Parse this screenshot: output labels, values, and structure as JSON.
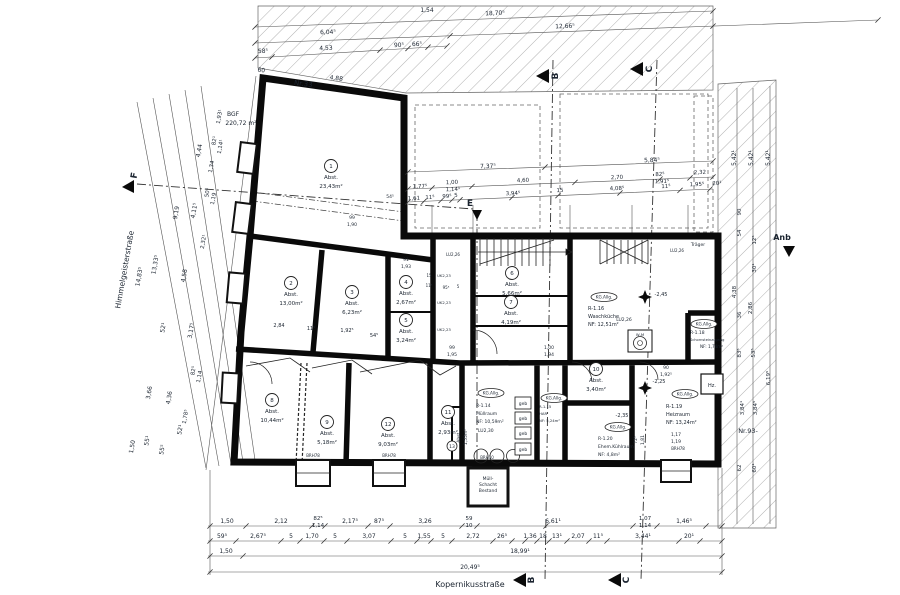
{
  "streets": {
    "left": "Himmelgeisterstraße",
    "bottom": "Kopernikusstraße"
  },
  "markers": {
    "b": "B",
    "c": "C",
    "e": "E",
    "f": "F"
  },
  "labels": {
    "kg": "KG.Allg.",
    "hz": "Hz.",
    "wm": "W-M",
    "traeger": "Träger",
    "geb": "geb",
    "brh78": "BRH78",
    "brh10": "BRH10",
    "lu226": "LU2,26",
    "lu230": "LU2,30",
    "uk223": "UK2,23",
    "lvl245": "-2,45",
    "lvl225": "-2,25",
    "lvl235": "-2,35",
    "muell1": "Müll-",
    "muell2": "Schacht",
    "muell3": "Bestand",
    "bgf1": "BGF",
    "bgf2": "220,72 m²",
    "nr33": "Nr.33",
    "nr93": "Nr.93-",
    "anb": "Anb"
  },
  "rooms": {
    "r1": {
      "num": "1",
      "label": "Abst.",
      "area": "23,43m²"
    },
    "r2": {
      "num": "2",
      "label": "Abst.",
      "area": "13,00m²"
    },
    "r3": {
      "num": "3",
      "label": "Abst.",
      "area": "6,23m²"
    },
    "r4": {
      "num": "4",
      "label": "Abst.",
      "area": "2,67m²"
    },
    "r5": {
      "num": "5",
      "label": "Abst.",
      "area": "3,24m²"
    },
    "r6": {
      "num": "6",
      "label": "Abst.",
      "area": "5,66m²"
    },
    "r7": {
      "num": "7",
      "label": "Abst.",
      "area": "4,19m²"
    },
    "r8": {
      "num": "8",
      "label": "Abst.",
      "area": "10,44m²"
    },
    "r9": {
      "num": "9",
      "label": "Abst.",
      "area": "5,18m²"
    },
    "r10": {
      "num": "10",
      "label": "Abst.",
      "area": "3,40m²"
    },
    "r11": {
      "num": "11",
      "label": "Abst.",
      "area": "2,93m²"
    },
    "r12": {
      "num": "12",
      "label": "Abst.",
      "area": "9,03m²"
    },
    "r13": {
      "num": "13",
      "label": "Abst.",
      "area": "1,55m²"
    }
  },
  "units": {
    "r114": {
      "code": "R-1.14",
      "name": "Müllraum",
      "nf": "NF: 10,59m²"
    },
    "r115": {
      "code": "R-1.15",
      "name": "HAR",
      "nf": "NF: 5,24m²"
    },
    "r116": {
      "code": "R-1.16",
      "name": "Waschküche",
      "nf": "NF: 12,51m²"
    },
    "r118": {
      "code": "R-1.18",
      "name": "Schornsteinzugang",
      "nf": "NF: 1,74m²"
    },
    "r119": {
      "code": "R-1.19",
      "name": "Heizraum",
      "nf": "NF: 13,24m²"
    },
    "r120": {
      "code": "R-1.20",
      "name": "Ehem.Kühlraum",
      "nf": "NF: 4,8m²"
    }
  },
  "dims": {
    "top": [
      "18,70⁵",
      "6,04⁵",
      "12,66⁵",
      "58⁵",
      "4,53",
      "90⁵",
      "66⁵",
      "60",
      "4,88",
      "1,54"
    ],
    "court1": [
      "7,37⁵",
      "5,84⁵"
    ],
    "court2": [
      "1,77⁵",
      "1,00",
      "1,14¹",
      "4,60",
      "2,70",
      "82⁵",
      "1,91⁵",
      "2,32"
    ],
    "court3": [
      "1,61",
      "11⁵",
      "99⁵",
      "5",
      "3,94⁵",
      "15",
      "4,08⁵",
      "11⁵",
      "1,95⁵",
      "20¹"
    ],
    "left": [
      "14,83⁵",
      "1,50",
      "13,33⁵",
      "3,66",
      "55¹",
      "9,19",
      "52¹",
      "4,36",
      "55⁵",
      "4,44",
      "4,11⁵",
      "4,58",
      "3,17⁵",
      "52¹",
      "1,93¹",
      "82¹",
      "1,14¹",
      "1,34",
      "50⁵",
      "1,19",
      "2,32¹",
      "82⁵",
      "1,14",
      "1,78⁵"
    ],
    "right": [
      "5,42¹",
      "5,42¹",
      "5,42¹",
      "90",
      "54",
      "12⁵",
      "30¹",
      "4,38",
      "2,86",
      "36",
      "83⁵",
      "53⁵",
      "3,84¹",
      "3,84⁵",
      "6,19⁵",
      "62",
      "60¹"
    ],
    "bottom1": [
      "1,50",
      "2,12",
      "82⁵",
      "1,14",
      "2,17⁵",
      "87⁵",
      "3,26",
      "59",
      "10",
      "6,61¹",
      "1,07",
      "1,14",
      "1,46⁵"
    ],
    "bottom2": [
      "59⁵",
      "2,67⁵",
      "5",
      "1,70",
      "5",
      "3,07",
      "5",
      "1,55",
      "5",
      "2,72",
      "26⁵",
      "1,36",
      "18",
      "13¹",
      "2,07",
      "11⁵",
      "3,44¹",
      "20¹"
    ],
    "bottom3": [
      "1,50",
      "18,99¹"
    ],
    "bottom4": [
      "20,49⁵"
    ],
    "inner": [
      "99",
      "1,90",
      "54⁵",
      "91",
      "1,93",
      "2,84",
      "11⁵",
      "1,92⁵",
      "54⁵",
      "99",
      "1,95",
      "1,00",
      "1,94",
      "15",
      "11⁵",
      "90",
      "1,92⁵",
      "72⁵",
      "1,81",
      "1,17",
      "1,19",
      "95⁵",
      "5"
    ]
  }
}
